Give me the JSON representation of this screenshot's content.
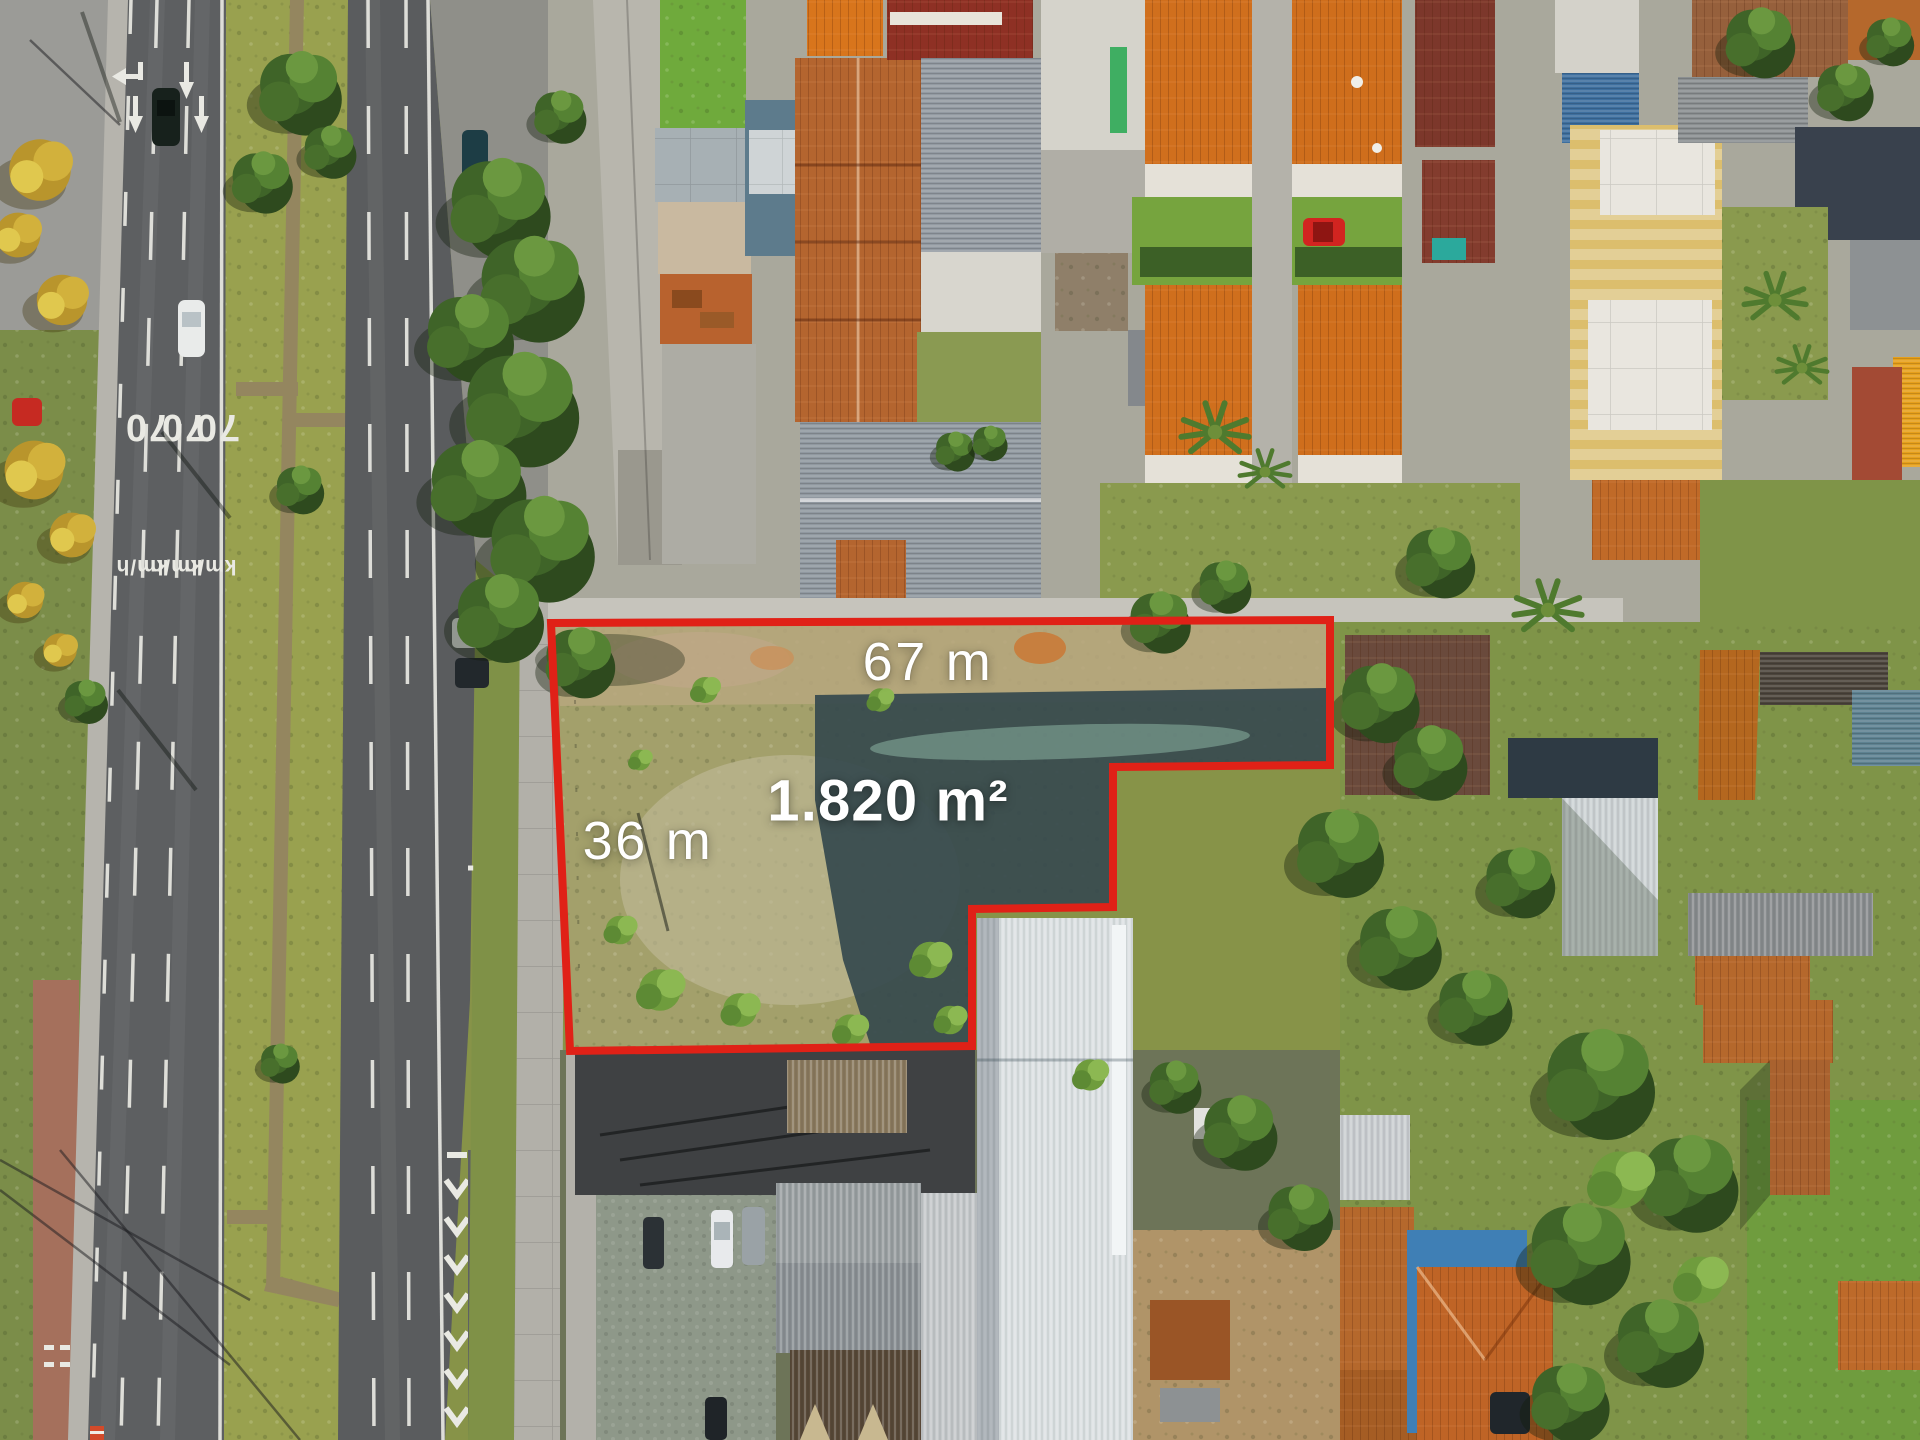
{
  "image_type": "aerial-drone-photo-land-listing",
  "overlay": {
    "width_label": "67 m",
    "depth_label": "36 m",
    "area_label": "1.820 m²",
    "boundary_color": "#e02117",
    "label_color": "#ffffff"
  },
  "road_markings": {
    "speed_labels": [
      "70",
      "70",
      "70"
    ],
    "unit_labels": [
      "km/h",
      "km/h",
      "km/h"
    ],
    "paint_color": "#e9e9e3"
  }
}
